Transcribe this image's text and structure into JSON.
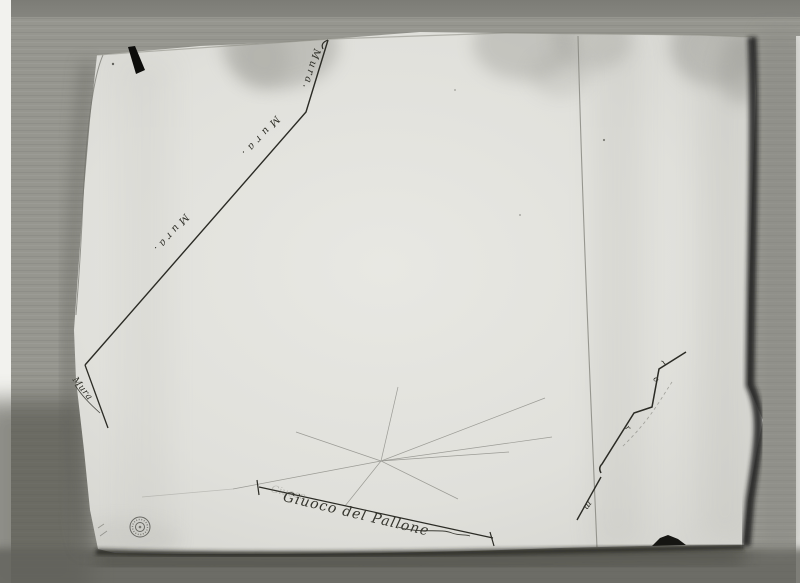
{
  "meta": {
    "description": "Black-and-white archival photograph of an aged hand-drawn plan sketch on paper, photographed on corrugated cardboard",
    "photo_tones": {
      "cardboard": "#96968f",
      "cardboard_top_band": "#7c7c76",
      "paper": "#e2e2dd",
      "stain": "#9e9e98",
      "ink": "#2b2b25",
      "shadow": "#23231f"
    }
  },
  "paper": {
    "labels": {
      "wall_label_repeats": [
        "Mura.",
        "Mura.",
        "Mura."
      ],
      "wall_label_vertex": "Mura",
      "court_label": "Giuoco del Pallone",
      "court_label_ghost": "Giuoco",
      "zigzag_marks": {
        "squiggle": "~",
        "letter_o": "o",
        "letter_r": "r",
        "letter_m": "m"
      }
    },
    "icons": {
      "stamp_icon": "circular-archive-stamp"
    }
  }
}
